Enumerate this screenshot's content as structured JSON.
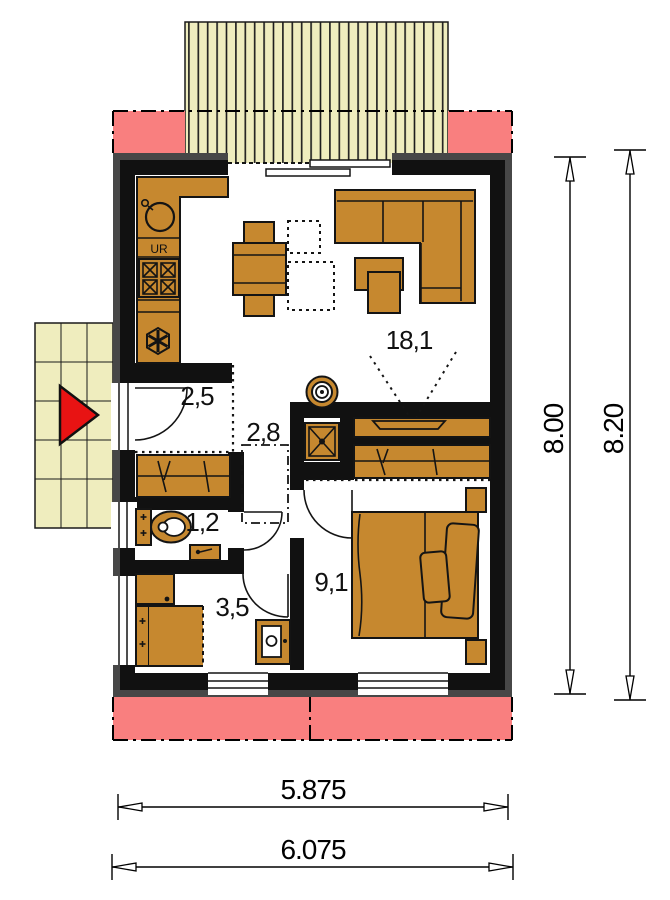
{
  "colors": {
    "wall": "#111111",
    "outer": "#474747",
    "furniture": "#C6882F",
    "deck": "#EFEDBE",
    "overhang": "#F97F7F",
    "arrow": "#E81313"
  },
  "plan": {
    "rooms": {
      "living": "18,1",
      "hall": "2,5",
      "corridor": "2,8",
      "wc": "1,2",
      "bathroom": "3,5",
      "bedroom": "9,1"
    },
    "kitchen": {
      "dishwasher_label": "UR"
    },
    "dimensions": {
      "height_inner": "8.00",
      "height_outer": "8.20",
      "width_inner": "5.875",
      "width_outer": "6.075"
    }
  }
}
